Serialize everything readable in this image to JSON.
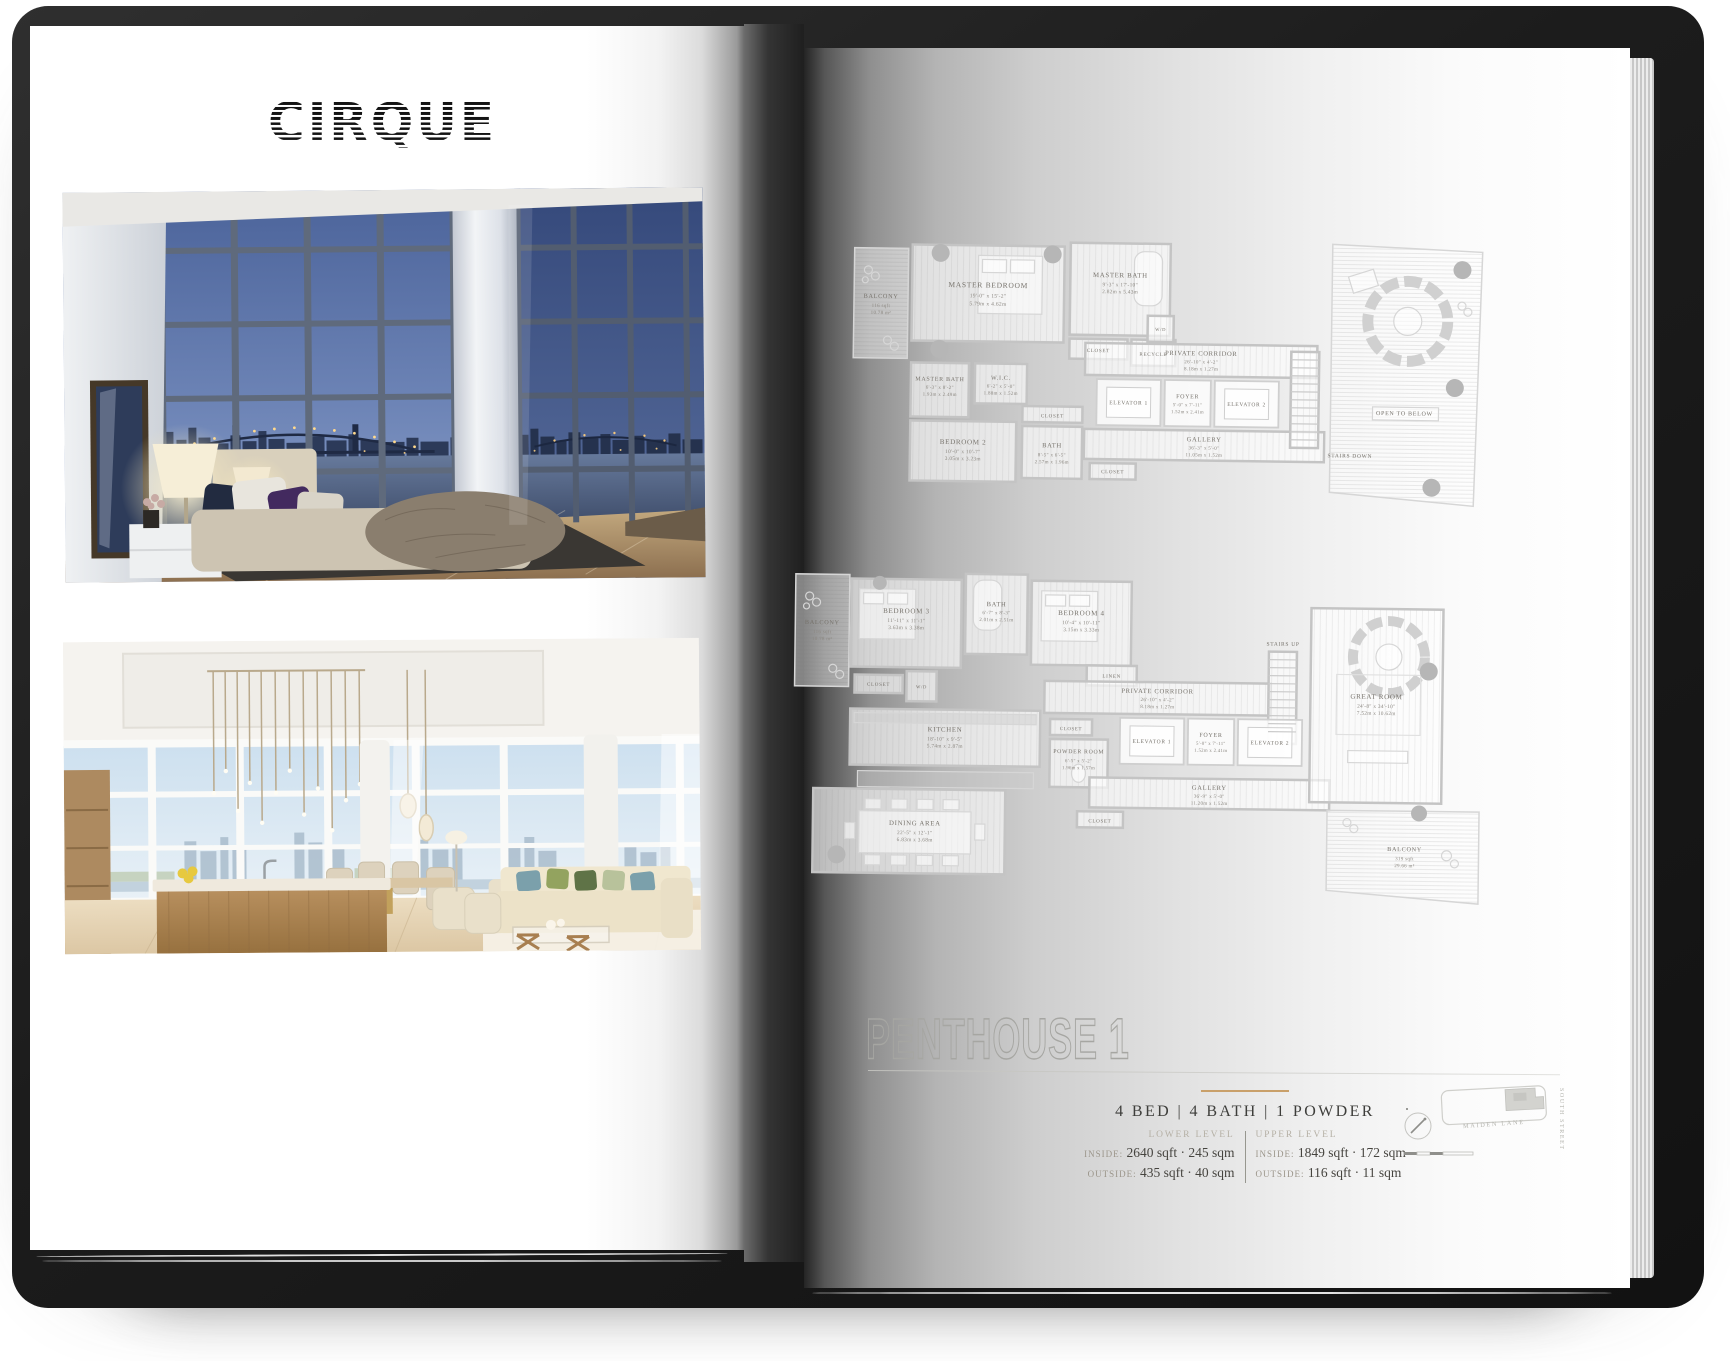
{
  "brand": {
    "logo_text": "CIRQUE"
  },
  "left_page": {
    "photos": [
      {
        "name": "Master bedroom at dusk with bridge and skyline view"
      },
      {
        "name": "Great room and kitchen with daytime city view"
      }
    ]
  },
  "right_page": {
    "title": "PENTHOUSE 1",
    "specs": {
      "headline": "4 BED | 4 BATH | 1 POWDER",
      "levels": [
        {
          "level": "LOWER LEVEL",
          "inside_label": "INSIDE:",
          "inside_value": "2640 sqft · 245 sqm",
          "outside_label": "OUTSIDE:",
          "outside_value": "435 sqft · 40 sqm"
        },
        {
          "level": "UPPER LEVEL",
          "inside_label": "INSIDE:",
          "inside_value": "1849 sqft · 172 sqm",
          "outside_label": "OUTSIDE:",
          "outside_value": "116 sqft · 11 sqm"
        }
      ]
    },
    "map": {
      "street_bottom": "MAIDEN LANE",
      "street_right": "SOUTH STREET"
    },
    "shared_labels": {
      "closet": "CLOSET",
      "wd": "W/D",
      "linen": "LINEN",
      "recycle": "RECYCLE",
      "elevator1": "ELEVATOR 1",
      "elevator2": "ELEVATOR 2",
      "stairs_down": "STAIRS DOWN",
      "stairs_up": "STAIRS UP",
      "open_to_below": "OPEN TO BELOW"
    },
    "plans": {
      "upper": {
        "balcony": {
          "name": "BALCONY",
          "a": "116 sqft",
          "b": "10.78 m²"
        },
        "master_bedroom": {
          "name": "MASTER BEDROOM",
          "ft": "19'-0\" x 15'-2\"",
          "m": "5.79m x 4.62m"
        },
        "master_bath_1": {
          "name": "MASTER BATH",
          "ft": "9'-3\" x 17'-10\"",
          "m": "2.82m x 5.43m"
        },
        "master_bath_2": {
          "name": "MASTER BATH",
          "ft": "6'-3\" x 8'-2\"",
          "m": "1.93m x 2.49m"
        },
        "wic": {
          "name": "W.I.C.",
          "ft": "6'-2\" x 5'-0\"",
          "m": "1.88m x 1.52m"
        },
        "bedroom_2": {
          "name": "BEDROOM 2",
          "ft": "10'-0\" x 10'-7\"",
          "m": "3.05m x 3.23m"
        },
        "bath": {
          "name": "BATH",
          "ft": "8'-5\" x 6'-5\"",
          "m": "2.57m x 1.96m"
        },
        "private_corridor": {
          "name": "PRIVATE CORRIDOR",
          "ft": "26'-10\" x 4'-2\"",
          "m": "8.18m x 1.27m"
        },
        "foyer": {
          "name": "FOYER",
          "ft": "5'-0\" x 7'-11\"",
          "m": "1.52m x 2.41m"
        },
        "gallery": {
          "name": "GALLERY",
          "ft": "36'-3\" x 5'-0\"",
          "m": "11.05m x 1.52m"
        }
      },
      "lower": {
        "balcony_left": {
          "name": "BALCONY",
          "a": "116 sqft",
          "b": "10.78 m²"
        },
        "balcony_right": {
          "name": "BALCONY",
          "a": "319 sqft",
          "b": "29.66 m²"
        },
        "bedroom_3": {
          "name": "BEDROOM 3",
          "ft": "11'-11\" x 11'-1\"",
          "m": "3.63m x 3.38m"
        },
        "bath": {
          "name": "BATH",
          "ft": "6'-7\" x 8'-3\"",
          "m": "2.01m x 2.51m"
        },
        "bedroom_4": {
          "name": "BEDROOM 4",
          "ft": "10'-4\" x 10'-11\"",
          "m": "3.15m x 3.33m"
        },
        "kitchen": {
          "name": "KITCHEN",
          "ft": "18'-10\" x 9'-5\"",
          "m": "5.74m x 2.87m"
        },
        "dining": {
          "name": "DINING AREA",
          "ft": "22'-5\" x 12'-1\"",
          "m": "6.83m x 3.68m"
        },
        "powder": {
          "name": "POWDER ROOM",
          "ft": "6'-5\" x 5'-2\"",
          "m": "1.96m x 1.57m"
        },
        "private_corridor": {
          "name": "PRIVATE CORRIDOR",
          "ft": "26'-10\" x 4'-2\"",
          "m": "8.18m x 1.27m"
        },
        "foyer": {
          "name": "FOYER",
          "ft": "5'-0\" x 7'-11\"",
          "m": "1.52m x 2.41m"
        },
        "gallery": {
          "name": "GALLERY",
          "ft": "36'-9\" x 5'-0\"",
          "m": "11.20m x 1.52m"
        },
        "great_room": {
          "name": "GREAT ROOM",
          "ft": "24'-8\" x 34'-10\"",
          "m": "7.52m x 10.62m"
        }
      }
    }
  }
}
